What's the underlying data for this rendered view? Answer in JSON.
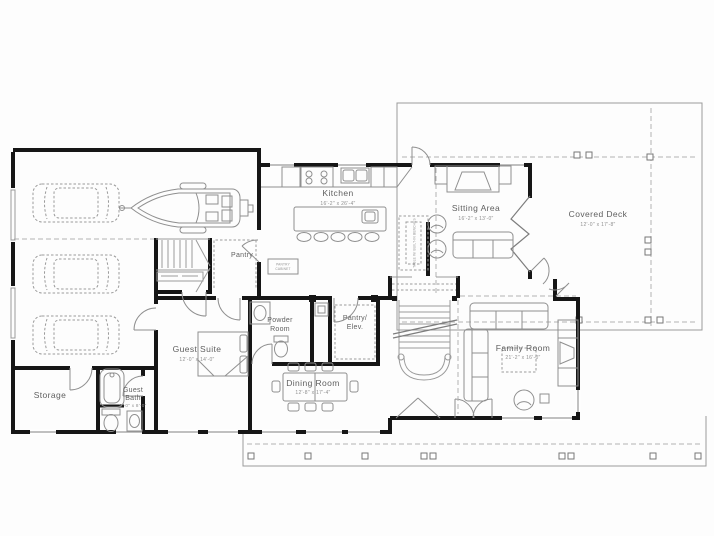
{
  "plan": {
    "rooms": {
      "kitchen": {
        "name": "Kitchen",
        "dims": "16'-2\" x 26'-4\""
      },
      "sitting": {
        "name": "Sitting Area",
        "dims": "16'-2\" x 13'-0\""
      },
      "deck": {
        "name": "Covered Deck",
        "dims": "12'-0\" x 17'-8\""
      },
      "pantry": {
        "name": "Pantry"
      },
      "powder": {
        "name_line1": "Powder",
        "name_line2": "Room"
      },
      "pantry_elev": {
        "name_line1": "Pantry/",
        "name_line2": "Elev."
      },
      "guest_suite": {
        "name": "Guest Suite",
        "dims": "12'-0\" x 14'-0\""
      },
      "dining": {
        "name": "Dining Room",
        "dims": "12'-8\" x 17'-4\""
      },
      "family": {
        "name": "Family Room",
        "dims": "21'-2\" x 16'-0\""
      },
      "storage": {
        "name": "Storage"
      },
      "guest_bath": {
        "name_line1": "Guest",
        "name_line2": "Bath",
        "dims": "9'-0\" x 8'-0\""
      }
    },
    "annotations": {
      "banquette": "TABLE W/ BUILT-IN BENCHES",
      "pantry_cabinet_line1": "PANTRY",
      "pantry_cabinet_line2": "CABINET"
    },
    "colors": {
      "walls": "#161616",
      "fixtures": "#8f8f8f",
      "dashed": "#b2b2b2",
      "room_label": "#5f5f5f",
      "dimension_label": "#8f8f8f",
      "background": "#fdfdfd"
    }
  }
}
